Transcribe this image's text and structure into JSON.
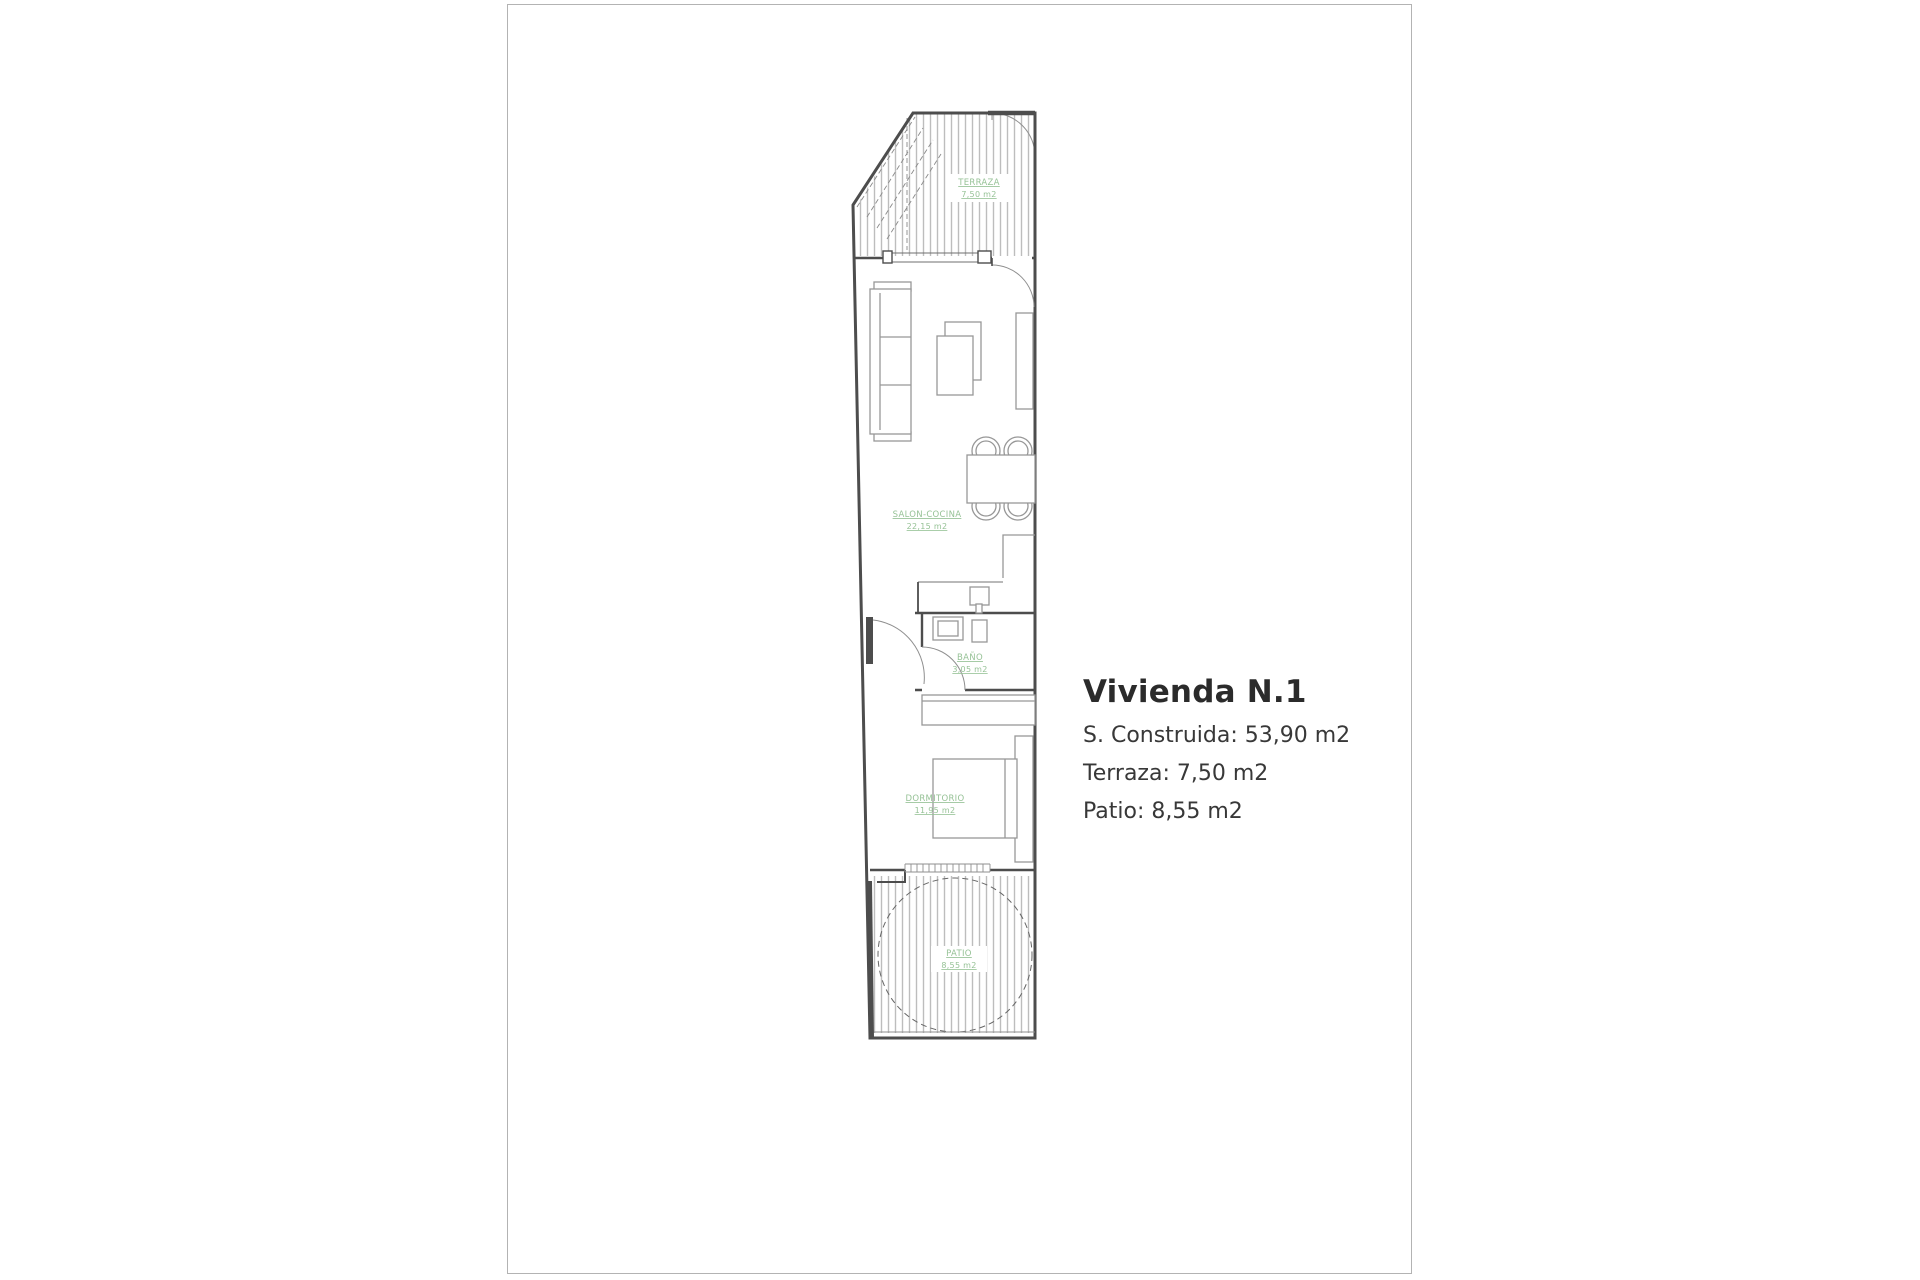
{
  "page": {
    "background": "#ffffff",
    "border_color": "#b3b3b3"
  },
  "info_panel": {
    "title": "Vivienda N.1",
    "lines": [
      "S. Construida: 53,90 m2",
      "Terraza: 7,50 m2",
      "Patio: 8,55 m2"
    ]
  },
  "floorplan": {
    "colors": {
      "wall": "#4d4d4d",
      "furniture": "#979797",
      "hatch": "#bdbdbd",
      "dash": "#666666",
      "label": "#96c296"
    },
    "rooms": {
      "terraza": {
        "name": "TERRAZA",
        "area": "7,50 m2"
      },
      "salon": {
        "name": "SALON-COCINA",
        "area": "22,15 m2"
      },
      "bano": {
        "name": "BAÑO",
        "area": "3,05 m2"
      },
      "dormitorio": {
        "name": "DORMITORIO",
        "area": "11,95 m2"
      },
      "patio": {
        "name": "PATIO",
        "area": "8,55 m2"
      }
    }
  }
}
